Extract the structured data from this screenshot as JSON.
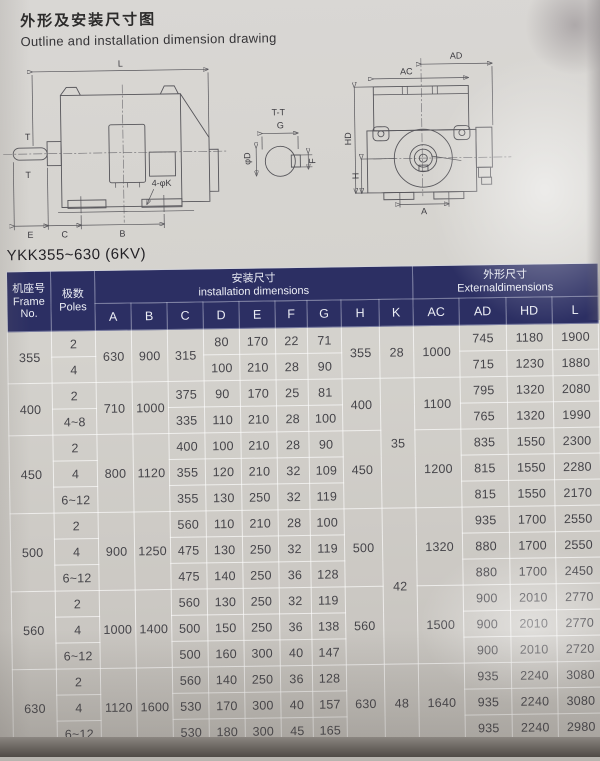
{
  "page": {
    "title_zh": "外形及安装尺寸图",
    "title_en": "Outline and installation dimension drawing",
    "model": "YKK355~630 (6KV)"
  },
  "drawings": {
    "side": {
      "dim_l": "L",
      "t_top": "T",
      "t_bottom": "T",
      "holes": "4-φK",
      "dim_e": "E",
      "dim_c": "C",
      "dim_b": "B"
    },
    "section": {
      "title": "T-T",
      "dim_g": "G",
      "dim_f": "F",
      "dim_d": "φD"
    },
    "end": {
      "dim_ac": "AC",
      "dim_ad": "AD",
      "dim_hd": "HD",
      "dim_h": "H",
      "dim_a": "A"
    }
  },
  "table": {
    "header": {
      "frame_zh": "机座号",
      "frame_en_1": "Frame",
      "frame_en_2": "No.",
      "poles_zh": "极数",
      "poles_en": "Poles",
      "install_zh": "安装尺寸",
      "install_en": "installation dimensions",
      "external_zh": "外形尺寸",
      "external_en": "Externaldimensions",
      "cols": [
        "A",
        "B",
        "C",
        "D",
        "E",
        "F",
        "G",
        "H",
        "K",
        "AC",
        "AD",
        "HD",
        "L"
      ]
    },
    "rows": [
      {
        "frame": "355",
        "poles": "2",
        "A": "630",
        "B": "900",
        "C": "315",
        "D": "80",
        "E": "170",
        "F": "22",
        "G": "71",
        "H": "355",
        "K": "28",
        "AC": "1000",
        "AD": "745",
        "HD": "1180",
        "L": "1900"
      },
      {
        "poles": "4",
        "D": "100",
        "E": "210",
        "F": "28",
        "G": "90",
        "AD": "715",
        "HD": "1230",
        "L": "1880"
      },
      {
        "frame": "400",
        "poles": "2",
        "A": "710",
        "B": "1000",
        "C": "375",
        "D": "90",
        "E": "170",
        "F": "25",
        "G": "81",
        "H": "400",
        "K": "35",
        "AC": "1100",
        "AD": "795",
        "HD": "1320",
        "L": "2080"
      },
      {
        "poles": "4~8",
        "C": "335",
        "D": "110",
        "E": "210",
        "F": "28",
        "G": "100",
        "AD": "765",
        "HD": "1320",
        "L": "1990"
      },
      {
        "frame": "450",
        "poles": "2",
        "A": "800",
        "B": "1120",
        "C": "400",
        "D": "100",
        "E": "210",
        "F": "28",
        "G": "90",
        "H": "450",
        "AC": "1200",
        "AD": "835",
        "HD": "1550",
        "L": "2300"
      },
      {
        "poles": "4",
        "C": "355",
        "D": "120",
        "E": "210",
        "F": "32",
        "G": "109",
        "AD": "815",
        "HD": "1550",
        "L": "2280"
      },
      {
        "poles": "6~12",
        "C": "355",
        "D": "130",
        "E": "250",
        "F": "32",
        "G": "119",
        "AD": "815",
        "HD": "1550",
        "L": "2170"
      },
      {
        "frame": "500",
        "poles": "2",
        "A": "900",
        "B": "1250",
        "C": "560",
        "D": "110",
        "E": "210",
        "F": "28",
        "G": "100",
        "H": "500",
        "K": "42",
        "AC": "1320",
        "AD": "935",
        "HD": "1700",
        "L": "2550"
      },
      {
        "poles": "4",
        "C": "475",
        "D": "130",
        "E": "250",
        "F": "32",
        "G": "119",
        "AD": "880",
        "HD": "1700",
        "L": "2550"
      },
      {
        "poles": "6~12",
        "C": "475",
        "D": "140",
        "E": "250",
        "F": "36",
        "G": "128",
        "AD": "880",
        "HD": "1700",
        "L": "2450"
      },
      {
        "frame": "560",
        "poles": "2",
        "A": "1000",
        "B": "1400",
        "C": "560",
        "D": "130",
        "E": "250",
        "F": "32",
        "G": "119",
        "H": "560",
        "AC": "1500",
        "AD": "900",
        "HD": "2010",
        "L": "2770"
      },
      {
        "poles": "4",
        "C": "500",
        "D": "150",
        "E": "250",
        "F": "36",
        "G": "138",
        "AD": "900",
        "HD": "2010",
        "L": "2770"
      },
      {
        "poles": "6~12",
        "C": "500",
        "D": "160",
        "E": "300",
        "F": "40",
        "G": "147",
        "AD": "900",
        "HD": "2010",
        "L": "2720"
      },
      {
        "frame": "630",
        "poles": "2",
        "A": "1120",
        "B": "1600",
        "C": "560",
        "D": "140",
        "E": "250",
        "F": "36",
        "G": "128",
        "H": "630",
        "K": "48",
        "AC": "1640",
        "AD": "935",
        "HD": "2240",
        "L": "3080"
      },
      {
        "poles": "4",
        "C": "530",
        "D": "170",
        "E": "300",
        "F": "40",
        "G": "157",
        "AD": "935",
        "HD": "2240",
        "L": "3080"
      },
      {
        "poles": "6~12",
        "C": "530",
        "D": "180",
        "E": "300",
        "F": "45",
        "G": "165",
        "AD": "935",
        "HD": "2240",
        "L": "2980"
      }
    ]
  }
}
